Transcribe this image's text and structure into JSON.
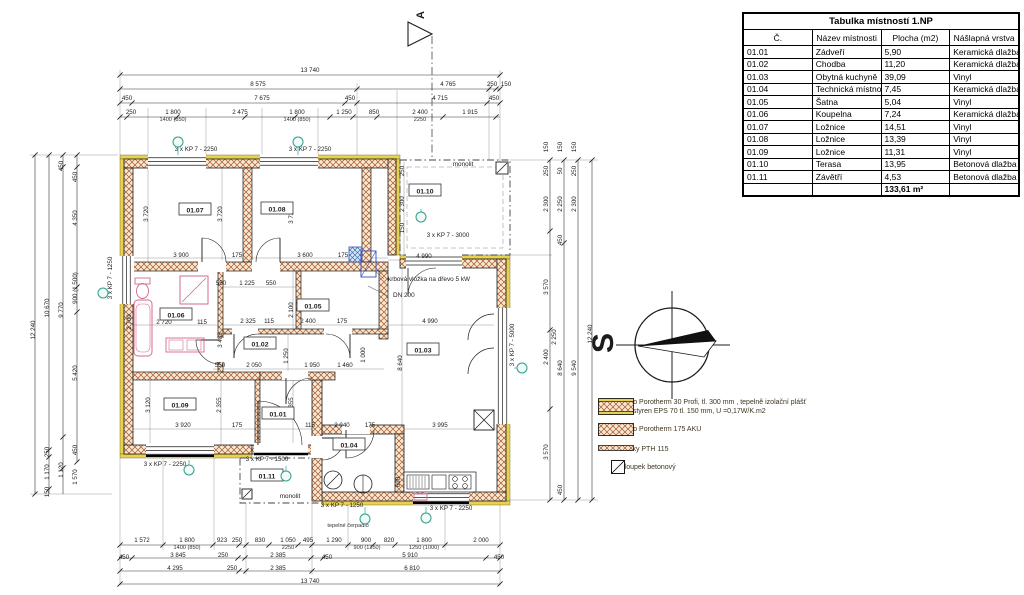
{
  "table": {
    "title": "Tabulka místností 1.NP",
    "headers": [
      "Č.",
      "Název místnosti",
      "Plocha (m2)",
      "Nášlapná vrstva"
    ],
    "rows": [
      [
        "01.01",
        "Zádveří",
        "5,90",
        "Keramická dlažba"
      ],
      [
        "01.02",
        "Chodba",
        "11,20",
        "Keramická dlažba"
      ],
      [
        "01.03",
        "Obytná kuchyně",
        "39,09",
        "Vinyl"
      ],
      [
        "01.04",
        "Technická místnost",
        "7,45",
        "Keramická dlažba"
      ],
      [
        "01.05",
        "Šatna",
        "5,04",
        "Vinyl"
      ],
      [
        "01.06",
        "Koupelna",
        "7,24",
        "Keramická dlažba"
      ],
      [
        "01.07",
        "Ložnice",
        "14,51",
        "Vinyl"
      ],
      [
        "01.08",
        "Ložnice",
        "13,39",
        "Vinyl"
      ],
      [
        "01.09",
        "Ložnice",
        "11,31",
        "Vinyl"
      ],
      [
        "01.10",
        "Terasa",
        "13,95",
        "Betonová dlažba"
      ],
      [
        "01.11",
        "Závětří",
        "4,53",
        "Betonová dlažba"
      ]
    ],
    "total": "133,61 m²"
  },
  "legend": {
    "items": [
      {
        "text": "Zdivo Porotherm 30 Profi, tl. 300 mm , tepelně izolační plášť",
        "text2": "polystyren EPS 70 tl. 150 mm, U =0,17W/K.m2"
      },
      {
        "text": "Zdivo Porotherm 175 AKU"
      },
      {
        "text": "Příčky PTH 115"
      },
      {
        "text": "Sloupek betonový"
      }
    ]
  },
  "compass": {
    "north_label": "S"
  },
  "plan": {
    "section_label": "A",
    "rooms": [
      "01.07",
      "01.08",
      "01.10",
      "01.06",
      "01.05",
      "01.02",
      "01.03",
      "01.09",
      "01.01",
      "01.04",
      "01.11"
    ],
    "dims_top": [
      "13 740",
      "8 575",
      "4 765",
      "250",
      "150",
      "450",
      "7 675",
      "450",
      "4 715",
      "450",
      "250",
      "1 800",
      "2 475",
      "1 800",
      "1 250",
      "850",
      "2 400",
      "1 915",
      "1400 (850)",
      "1400 (850)",
      "2250"
    ],
    "dims_bottom": [
      "1 572",
      "1 800",
      "923",
      "250",
      "830",
      "1 050",
      "495",
      "1 290",
      "900",
      "820",
      "1 800",
      "2 000",
      "1400 (850)",
      "2250",
      "900 (1350)",
      "1250 (1000)",
      "450",
      "3 845",
      "250",
      "2 385",
      "450",
      "5 910",
      "450",
      "4 295",
      "250",
      "2 385",
      "6 810",
      "13 740"
    ],
    "dims_left": [
      "12 240",
      "10 670",
      "250",
      "1 170",
      "450",
      "9 770",
      "1 120",
      "150",
      "450",
      "4 350",
      "900 (1 500)",
      "5 420",
      "450",
      "1 570"
    ],
    "dims_right": [
      "150",
      "150",
      "150",
      "250",
      "50",
      "250",
      "2 300",
      "2 250",
      "2 300",
      "450",
      "3 570",
      "2 400",
      "2 250",
      "8 640",
      "9 540",
      "3 570",
      "450",
      "12 240"
    ],
    "dims_inner": [
      "3 900",
      "175",
      "3 600",
      "175",
      "4 990",
      "3 720",
      "3 720",
      "3 720",
      "550",
      "1 225",
      "550",
      "2 720",
      "115",
      "2 325",
      "115",
      "2 400",
      "175",
      "2 100",
      "2 700",
      "3 485",
      "4 990",
      "8 640",
      "550",
      "2 050",
      "1 950",
      "1 460",
      "1 250",
      "1 000",
      "3 920",
      "175",
      "115",
      "2 040",
      "175",
      "2 355",
      "2 355",
      "3 120",
      "3 995",
      "250",
      "2 300",
      "150",
      "600"
    ],
    "window_labels": [
      "3 x KP 7 - 2250",
      "3 x KP 7 - 2250",
      "3 x KP 7 - 3000",
      "3 x KP 7 - 5000",
      "3 x KP 7 - 1250",
      "3 x KP 7 - 2250",
      "3 x KP 7 - 1500",
      "3 x KP 7 - 1250",
      "3 x KP 7 - 2250"
    ],
    "annotations": [
      "krbová vložka na dřevo 5 kW",
      "DN 200",
      "monolit",
      "monolit",
      "tepelné čerpadlo"
    ]
  }
}
